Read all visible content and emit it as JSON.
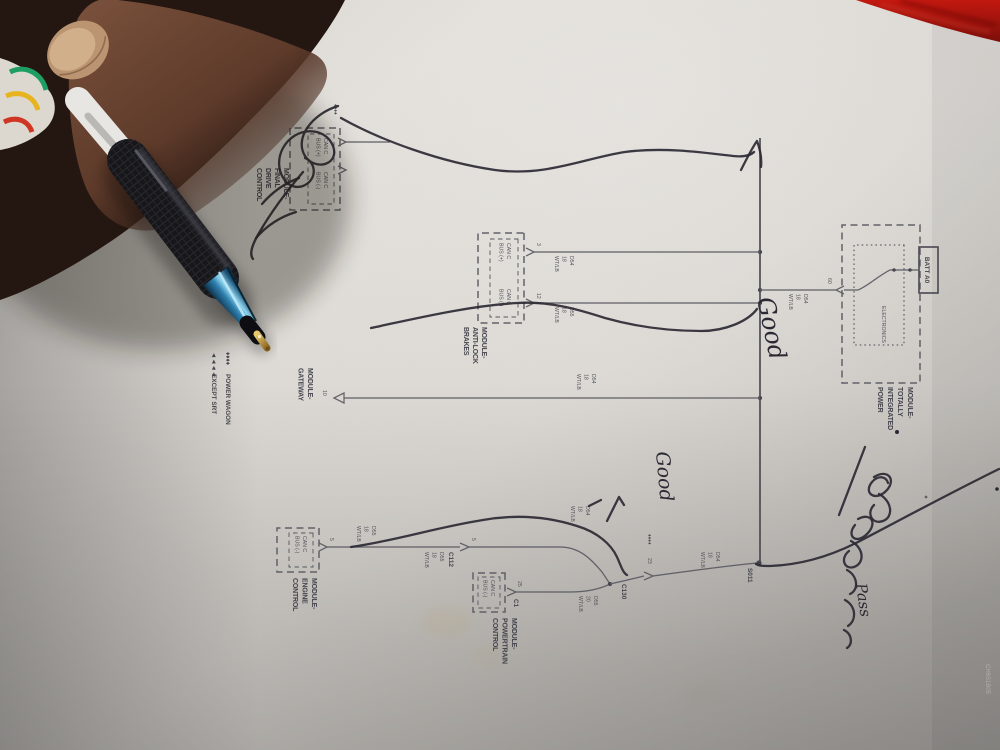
{
  "handwriting": {
    "good1": "Good",
    "good2": "Good",
    "pass": "Pass"
  },
  "margin": {
    "figure": "J0109B-4",
    "code": "CH6S1B05"
  },
  "notes": {
    "pw_bullets": "♦♦♦♦",
    "pw": "POWER WAGON",
    "srt_bullets": "◄◄◄◄",
    "srt": "EXCEPT SRT"
  },
  "wire_labels": {
    "d54_18": [
      "D54",
      "18",
      "WT/LB"
    ],
    "d55_18": [
      "D55",
      "18",
      "WT/LB"
    ],
    "d55_20": [
      "D55",
      "20",
      "WT/LB"
    ]
  },
  "connectors": {
    "s011": "S011",
    "c112": "C112",
    "c130": "C130",
    "c1": "C1",
    "c130_bullets": "♦♦♦♦",
    "pin_23": "23",
    "pin_25": "25",
    "pin_10": "10",
    "pin_3": "3",
    "pin_12": "12",
    "pin_5": "5",
    "pin_60": "60"
  },
  "modules": {
    "tipm": {
      "l": [
        "MODULE-",
        "TOTALLY",
        "INTEGRATED",
        "POWER"
      ],
      "fuse": "BATT A0",
      "inner": "ELECTRONICS"
    },
    "abs": {
      "l": [
        "MODULE-",
        "ANTI-LOCK",
        "BRAKES"
      ],
      "canp": [
        "CAN C",
        "BUS (+)"
      ],
      "canm": [
        "CAN C",
        "BUS (-)"
      ]
    },
    "gw": {
      "l": [
        "MODULE-",
        "GATEWAY"
      ]
    },
    "ecm": {
      "l": [
        "MODULE-",
        "ENGINE",
        "CONTROL"
      ],
      "canm": [
        "CAN C",
        "BUS (-)"
      ]
    },
    "pcm": {
      "l": [
        "MODULE-",
        "POWERTRAIN",
        "CONTROL"
      ],
      "canm": [
        "CAN C",
        "BUS (-)"
      ]
    },
    "fdcm": {
      "l": [
        "MODULE-",
        "FINAL",
        "DRIVE",
        "CONTROL"
      ],
      "bullets": "♦♦♦♦",
      "canp": [
        "CAN C",
        "BUS (+)"
      ],
      "canm": [
        "CAN C",
        "BUS (-)"
      ]
    }
  },
  "colors": {
    "paper": "#d8d5d0",
    "ink": "#4a4a52",
    "pen_ink": "#2b2933",
    "fabric_red": "#a51510",
    "pen_blue": "#2e7fae",
    "pen_gold": "#c79a3a"
  }
}
